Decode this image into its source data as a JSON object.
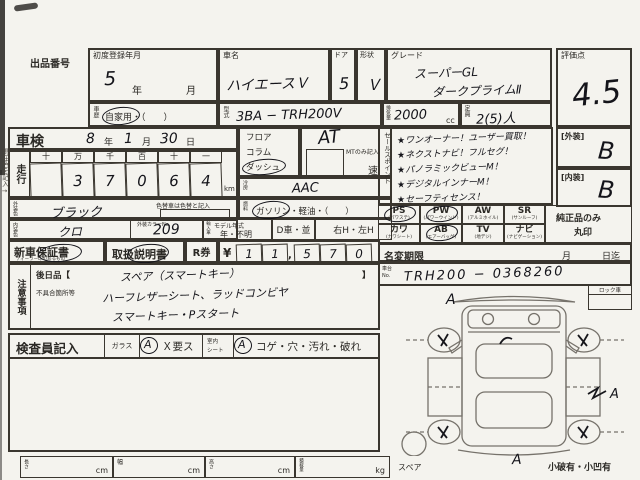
{
  "colors": {
    "paper": "#f4f3ee",
    "ink": "#2b2925",
    "hand": "#14141a",
    "diagram_line": "#76726b"
  },
  "header": {
    "lot_no_label": "出品番号",
    "first_reg": {
      "label": "初度登録年月",
      "year": "5",
      "year_suffix": "年",
      "month_suffix": "月"
    },
    "car_name": {
      "label": "車名",
      "value": "ハイエースＶ"
    },
    "door": {
      "label": "ドア",
      "value": "5"
    },
    "shape": {
      "label": "形状",
      "value": "Ｖ"
    },
    "grade": {
      "label": "グレード",
      "line1": "スーパーGL",
      "line2": "ダークプライムⅡ"
    },
    "score": {
      "label": "評価点",
      "value": "4.5"
    },
    "history": {
      "label": "車歴",
      "value": "自家用・（　　）"
    },
    "model_code": {
      "label": "型式",
      "value": "3BA − TRH200V"
    },
    "displacement": {
      "label": "排気量",
      "value": "2000",
      "unit": "cc"
    },
    "capacity": {
      "label": "定員",
      "value": "2(5)人"
    }
  },
  "left": {
    "margin_note": "現在色を記入→",
    "shaken": {
      "label": "車検",
      "year": "8",
      "year_l": "年",
      "month": "1",
      "month_l": "月",
      "day": "30",
      "day_l": "日"
    },
    "mileage": {
      "label": "走行",
      "digit_headers": [
        "十",
        "万",
        "千",
        "百",
        "十",
        "一"
      ],
      "digits": [
        "",
        "3",
        "7",
        "0",
        "6",
        "4"
      ],
      "unit": "km"
    },
    "ext_color": {
      "label": "外装色",
      "value": "ブラック",
      "note": "色替車は色替と記入"
    },
    "int_color": {
      "label": "内装色",
      "value": "クロ",
      "color_no_label": "外装カラーNo.",
      "color_no_value": "209"
    }
  },
  "mid": {
    "shift": {
      "opt1": "フロア",
      "opt2": "コラム",
      "opt3": "ダッシュ",
      "value": "AT",
      "mt_note": "MTのみ記入",
      "speed_suffix": "速"
    },
    "ac": {
      "label": "冷房",
      "value": "AAC"
    },
    "fuel": {
      "label": "燃料",
      "options": "ガソリン・軽油・（　　）"
    },
    "model_year": {
      "tag": "輸入車",
      "label": "モデル年式",
      "value": "年・不明"
    },
    "d_car": "D車・並",
    "handle": "右H・左H"
  },
  "sales": {
    "label": "セールスポイント",
    "points": [
      "★ワンオーナー！ユーザー買取！",
      "★ネクストナビ！フルセグ！",
      "★パノラミックビューM！",
      "★デジタルインナーM！",
      "★セーフティセンス！"
    ]
  },
  "equipment": {
    "cells": [
      {
        "abbr": "PS",
        "sub": "(パワステ)",
        "circled": true
      },
      {
        "abbr": "PW",
        "sub": "(パワーウインド)",
        "circled": true
      },
      {
        "abbr": "AW",
        "sub": "(アルミホイル)",
        "circled": false
      },
      {
        "abbr": "SR",
        "sub": "(サンルーフ)",
        "circled": false
      },
      {
        "abbr": "カワ",
        "sub": "(カワシート)",
        "circled": false
      },
      {
        "abbr": "AB",
        "sub": "(エアーバッグ)",
        "circled": true
      },
      {
        "abbr": "TV",
        "sub": "(地デジ)",
        "circled": false
      },
      {
        "abbr": "ナビ",
        "sub": "(ナビゲーション)",
        "circled": false
      }
    ],
    "note_line1": "純正品のみ",
    "note_line2": "丸印"
  },
  "grades": {
    "ext_label": "[外装]",
    "ext_value": "B",
    "int_label": "[内装]",
    "int_value": "B"
  },
  "name_change": {
    "label": "名変期限",
    "month": "月",
    "day": "日迄"
  },
  "chassis": {
    "label": "車台No.",
    "value": "TRH200 − 0368260"
  },
  "warranty": {
    "new_car": "新車保証書",
    "new_car_sub": "ディーラー印のあるもの",
    "manual": "取扱説明書",
    "r_ticket": "R券",
    "yen": "¥",
    "comma": ",",
    "amount_digits": [
      "1",
      "1",
      "5",
      "7",
      "0"
    ]
  },
  "notes": {
    "label": "注意事項",
    "later_label": "後日品【",
    "later_value": "スペア（スマートキー）",
    "later_close": "】",
    "defect_label": "不具合箇所等",
    "line1": "ハーフレザーシート、ラッドコンビヤ",
    "line2": "スマートキー・Pスタート"
  },
  "inspector": {
    "label": "検査員記入",
    "glass_label": "ガラス",
    "glass_mark": "A",
    "glass_note": "Ｘ要ス",
    "seat_label1": "室内",
    "seat_label2": "シート",
    "seat_mark": "A",
    "seat_note": "コゲ・穴・汚れ・破れ"
  },
  "dims": {
    "length_label": "長さ",
    "width_label": "幅",
    "height_label": "高さ",
    "load_label": "積載量",
    "cm": "cm",
    "kg": "kg"
  },
  "diagram": {
    "lock_label": "ロック車",
    "spare_label": "スペア",
    "center_mark": "A",
    "damage_note": "小破有・小凹有",
    "front_mark": "A",
    "side_mark": "A"
  }
}
